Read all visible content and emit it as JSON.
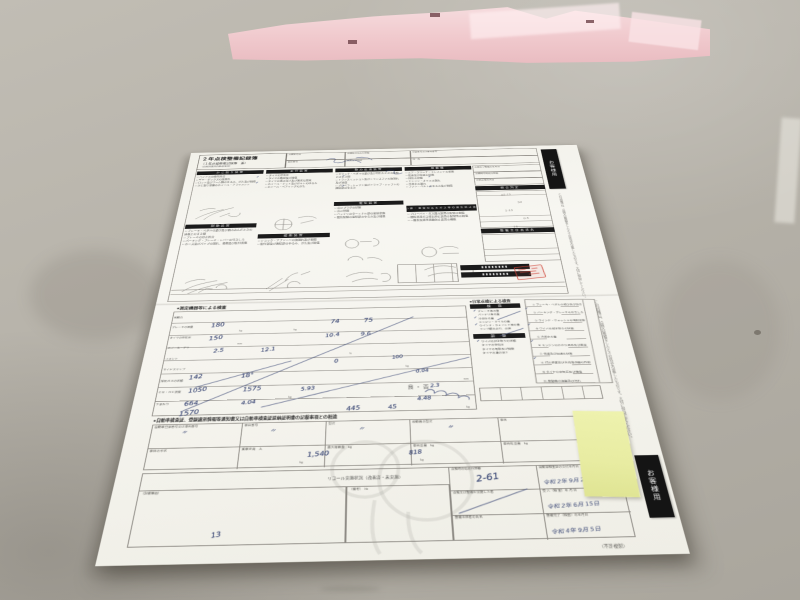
{
  "tabs": {
    "top": "お客様用",
    "bottom": "お客様用",
    "copy_note": "（不許複製）"
  },
  "top_form": {
    "title": "２年点検整備記録簿",
    "subtitle": "（１年点検整備記録簿　兼）",
    "subnote": "（自家用乗用自動車等用）",
    "header_cells": {
      "c1": "点検年月日",
      "c2": "点検時の総走行距離",
      "c3": "登録番号又は車両番号",
      "c4": "車台番号",
      "c5": "氏名又は名称",
      "c6": "住　所"
    },
    "col1": {
      "bar1": "かじ取り装置",
      "items1": "□ ハンドルの操作具合\n□ ギヤ・ボックスの油漏れ\n□ ロッド及びアーム類のゆるみ、がた及び損傷\n□ かじ取り車輪のホイール・アライメント",
      "bar2": "制動装置",
      "items2": "□ ブレーキ・ペダルの遊び及び踏み込んだときの床板とのすき間\n□ ブレーキの効き具合\n□ パーキング・ブレーキ・レバーの引きしろ\n□ ホース及びパイプの漏れ、損傷及び取付状態"
    },
    "col2": {
      "bar1": "走行装置",
      "items1": "□ タイヤの空気圧\n□ タイヤの亀裂及び損傷\n□ タイヤの溝の深さ及び異状な摩耗\n□ ホイール・ナット及びボルトのゆるみ\n□ ホイール・ベアリングのがた",
      "bar2": "緩衝装置",
      "items2": "□ ショック・アブソーバの油漏れ及び損傷\n□ 取付部及び連結部のゆるみ、がた及び損傷"
    },
    "col3": {
      "bar1": "動力伝達装置",
      "items1": "□ クラッチ・ペダルの遊び及び切れたときの床板とのすき間\n□ トランスミッション及びトランスファの油漏れ及び油量\n□ プロペラ・シャフト及びドライブ・シャフトの連結部のゆるみ",
      "bar2": "電気装置",
      "items2": "□ 点火プラグの状態\n□ 点火時期\n□ バッテリのターミナル部の接続状態\n□ 電気配線の接続部のゆるみ及び損傷"
    },
    "col4": {
      "bar1": "原動機",
      "items1": "□ エア・クリーナ・エレメントの状態\n□ 低速及び加速の状態\n□ 排気の状態\n□ エンジン・オイルの漏れ\n□ 冷却水の漏れ\n□ ファン・ベルトのゆるみ及び損傷",
      "bar2": "ばい煙・悪臭のあるガス等の発生防止装置",
      "items2": "□ ブローバイ・ガス還元装置の配管の損傷\n□ 燃料蒸発ガス排出抑止装置の配管等の損傷\n□ 一酸化炭素等発散防止装置の機能"
    },
    "col5": {
      "r1": "点検及び整備の年月日",
      "r2": "点検時の総走行距離",
      "r3": "次回点検年月日",
      "bar1": "総合判定",
      "bar2": "整備主任者氏名"
    },
    "strip_note": "この記録簿は、点検又は整備をしたときの状況を記載したものです。大切に保管してください。"
  },
  "bottom_form": {
    "header1": "●測定機器等による検査",
    "rowlabels_text": "制動力\nブレーキの液量\nタイヤの空気圧\nホイール・アライメント\nサイドスリップ\n排気ガスの状態\nＣＯ・ＨＣ濃度\n下まわり",
    "pass_fail": "良 ・ 否",
    "header_daily": "●日常点検による検査",
    "daily_bar1": "検　査",
    "daily_bar2": "調　整",
    "daily_items1": "ブレーキ液の量\nバッテリ液の量\n冷却水の量\nエンジン・オイルの量\nウインド・ウォッシャ液の量\nランプ類の点灯、点滅",
    "daily_items2": "ワイパの拭き取りの状態\nタイヤの空気圧\nタイヤの亀裂及び損傷\nタイヤの溝の深さ",
    "panel_items": "① ブレーキ・ペダルの遊び及び効き\n② パーキング・ブレーキの引きしろ\n③ ウインド・ウォッシャの噴射状態\n④ ワイパの拭き取りの状態\n⑤ 冷却水の量\n⑥ エンジンのかかり具合及び異音\n⑦ 低速及び加速の状態\n⑧ 灯火装置及び方向指示器の作用\n⑨ タイヤの空気圧及び損傷\n⑩ 原動機の油量及び汚れ",
    "header2": "●自動車検査証、登録識別情報等通知書又は自動車検査証返納証明書の記載事項との相違",
    "f1": "自動車登録番号又は車両番号",
    "f2": "車台番号",
    "f3": "型式",
    "f4": "原動機の型式",
    "f5": "車名",
    "g1": "車体の形状",
    "g2": "乗車定員　人",
    "g3": "最大積載量　kg",
    "g4": "車両重量　kg",
    "g5": "車両総重量　kg",
    "recall": "リコール実施状況（改善済・未実施）",
    "notes_box": "（記載事項）",
    "biko": "（備考）　№",
    "rt": {
      "l1": "点検時の総走行距離",
      "l1v": "2-61",
      "r1": "自動車検査証の交付年月日",
      "r1v": "令和 2年 9月 20日",
      "l2": "点検又は整備を実施した者",
      "r2": "受 入（検 査）年 月 日",
      "r2v": "令和 2年 6月 15日",
      "l3": "整備主任者の氏名",
      "r3": "整備完了（検査）の年月日",
      "r3v": "令和 4年 9月 5日"
    }
  },
  "handwriting": {
    "pen": [
      {
        "t": "180",
        "s": "left:76px;top:366px;font-size:9px;transform:rotate(-7deg)"
      },
      {
        "t": "74",
        "s": "left:226px;top:364px;font-size:9px;transform:rotate(-5deg)"
      },
      {
        "t": "75",
        "s": "left:268px;top:363px;font-size:9px;transform:rotate(-4deg)"
      },
      {
        "t": "150",
        "s": "left:76px;top:388px;font-size:9px;transform:rotate(-8deg)"
      },
      {
        "t": "10.4",
        "s": "left:220px;top:387px;font-size:8px;transform:rotate(-6deg)"
      },
      {
        "t": "9.6",
        "s": "left:264px;top:386px;font-size:8px;transform:rotate(-5deg)"
      },
      {
        "t": "2.5",
        "s": "left:84px;top:409px;font-size:8px;transform:rotate(-6deg)"
      },
      {
        "t": "12.1",
        "s": "left:142px;top:409px;font-size:8px;transform:rotate(-7deg)"
      },
      {
        "t": "0",
        "s": "left:232px;top:430px;font-size:8px;transform:rotate(-4deg)"
      },
      {
        "t": "100",
        "s": "left:302px;top:426px;font-size:7px;transform:rotate(-6deg)"
      },
      {
        "t": "0.04",
        "s": "left:330px;top:449px;font-size:7px;transform:rotate(-5deg)"
      },
      {
        "t": "142",
        "s": "left:60px;top:451px;font-size:8.5px;transform:rotate(-8deg)"
      },
      {
        "t": "18°",
        "s": "left:122px;top:450px;font-size:8.5px;transform:rotate(-6deg)"
      },
      {
        "t": "1050",
        "s": "left:62px;top:471px;font-size:8.5px;transform:rotate(-7deg)"
      },
      {
        "t": "1575",
        "s": "left:126px;top:471px;font-size:8.5px;transform:rotate(-6deg)"
      },
      {
        "t": "5.93",
        "s": "left:194px;top:472px;font-size:7.5px;transform:rotate(-6deg)"
      },
      {
        "t": "2.3",
        "s": "left:346px;top:472px;font-size:7px;transform:rotate(-5deg)"
      },
      {
        "t": "664",
        "s": "left:60px;top:491px;font-size:8.5px;transform:rotate(-7deg)"
      },
      {
        "t": "4.04",
        "s": "left:126px;top:491px;font-size:7.5px;transform:rotate(-6deg)"
      },
      {
        "t": "4.48",
        "s": "left:330px;top:490px;font-size:7.5px;transform:rotate(-5deg)"
      },
      {
        "t": "1570",
        "s": "left:56px;top:505px;font-size:9px;transform:rotate(-7deg)"
      },
      {
        "t": "445",
        "s": "left:248px;top:503px;font-size:8.5px;transform:rotate(-6deg)"
      },
      {
        "t": "45",
        "s": "left:296px;top:502px;font-size:8px;transform:rotate(-5deg)"
      },
      {
        "t": "〃",
        "s": "left:62px;top:533px;font-size:7px;transform:rotate(12deg)"
      },
      {
        "t": "〃",
        "s": "left:162px;top:533px;font-size:7px;transform:rotate(14deg)"
      },
      {
        "t": "〃",
        "s": "left:262px;top:533px;font-size:7px;transform:rotate(10deg)"
      },
      {
        "t": "〃",
        "s": "left:362px;top:533px;font-size:7px;transform:rotate(15deg)"
      },
      {
        "t": "1,540",
        "s": "left:206px;top:566px;font-size:8.5px;transform:rotate(-4deg)"
      },
      {
        "t": "818",
        "s": "left:318px;top:566px;font-size:7.5px;transform:rotate(-5deg)"
      },
      {
        "t": "13",
        "s": "left:112px;top:664px;font-size:8px;transform:rotate(-10deg)"
      },
      {
        "t": "✓",
        "s": "left:106px;top:62px;font-size:6px"
      },
      {
        "t": "✓",
        "s": "left:106px;top:76px;font-size:6px"
      },
      {
        "t": "✓",
        "s": "left:234px;top:64px;font-size:6px"
      },
      {
        "t": "✓",
        "s": "left:234px;top:88px;font-size:6px"
      },
      {
        "t": "✓",
        "s": "left:362px;top:70px;font-size:6px"
      },
      {
        "t": "✓",
        "s": "left:362px;top:94px;font-size:6px"
      },
      {
        "t": "✓",
        "s": "left:406px;top:352px;font-size:5.5px"
      },
      {
        "t": "✓",
        "s": "left:406px;top:364px;font-size:5.5px"
      },
      {
        "t": "✓",
        "s": "left:406px;top:376px;font-size:5.5px"
      },
      {
        "t": "✓",
        "s": "left:406px;top:404px;font-size:5.5px"
      },
      {
        "t": "✓",
        "s": "left:472px;top:350px;font-size:5.5px"
      },
      {
        "t": "✓",
        "s": "left:472px;top:378px;font-size:5.5px"
      },
      {
        "t": "✓",
        "s": "left:472px;top:406px;font-size:5.5px"
      },
      {
        "t": "✓",
        "s": "left:472px;top:434px;font-size:5.5px"
      }
    ],
    "pencil": [
      {
        "t": "05-15",
        "s": "left:466px;top:118px;font-size:5px;transform:rotate(-4deg)"
      },
      {
        "t": "50",
        "s": "left:488px;top:136px;font-size:5px;transform:rotate(-6deg)"
      },
      {
        "t": "1-15",
        "s": "left:468px;top:154px;font-size:5px;transform:rotate(-3deg)"
      },
      {
        "t": "0.5",
        "s": "left:492px;top:172px;font-size:5px;transform:rotate(-5deg)"
      },
      {
        "t": "15",
        "s": "left:476px;top:190px;font-size:5px;transform:rotate(-4deg)"
      }
    ],
    "units": [
      {
        "t": "kg",
        "s": "left:112px;top:378px;font-size:3.5px;color:#6a6965"
      },
      {
        "t": "kg",
        "s": "left:180px;top:378px;font-size:3.5px;color:#6a6965"
      },
      {
        "t": "mm",
        "s": "left:112px;top:400px;font-size:3.5px;color:#6a6965"
      },
      {
        "t": "%",
        "s": "left:250px;top:420px;font-size:3.5px;color:#6a6965"
      },
      {
        "t": "kg",
        "s": "left:318px;top:442px;font-size:3.5px;color:#6a6965"
      },
      {
        "t": "mm",
        "s": "left:386px;top:464px;font-size:3.5px;color:#6a6965"
      },
      {
        "t": "kg",
        "s": "left:180px;top:486px;font-size:3.5px;color:#6a6965"
      },
      {
        "t": "kg",
        "s": "left:386px;top:506px;font-size:3.5px;color:#6a6965"
      },
      {
        "t": "kg",
        "s": "left:198px;top:578px;font-size:3.5px;color:#6a6965"
      },
      {
        "t": "kg",
        "s": "left:330px;top:578px;font-size:3.5px;color:#6a6965"
      }
    ]
  }
}
